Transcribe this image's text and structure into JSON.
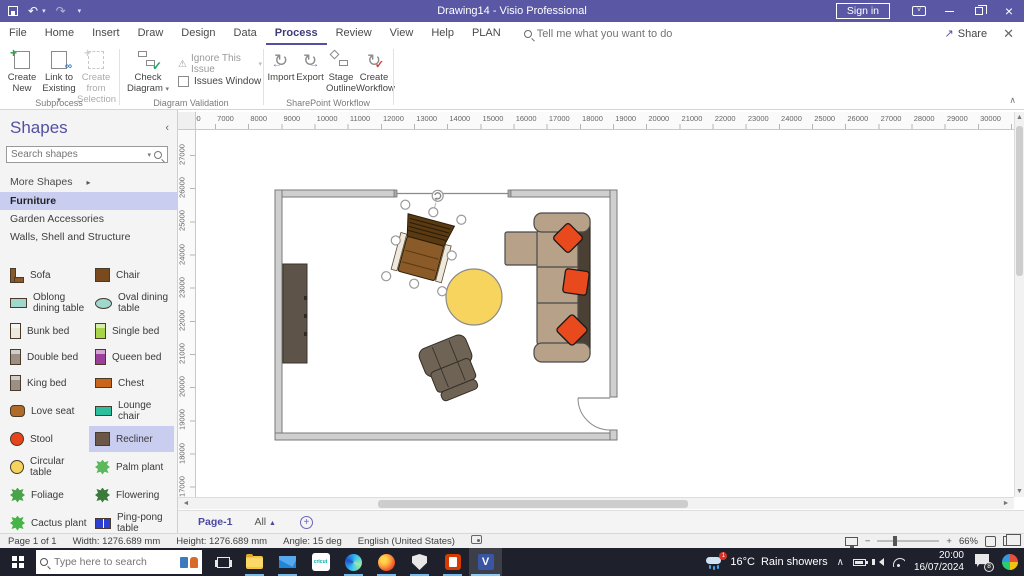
{
  "titlebar": {
    "title": "Drawing14 - Visio Professional",
    "sign_in": "Sign in"
  },
  "menu": {
    "tabs": [
      "File",
      "Home",
      "Insert",
      "Draw",
      "Design",
      "Data",
      "Process",
      "Review",
      "View",
      "Help",
      "PLAN"
    ],
    "active_tab": "Process",
    "search_placeholder": "Tell me what you want to do",
    "share": "Share"
  },
  "ribbon": {
    "subprocess": {
      "label": "Subprocess",
      "create_new": "Create New",
      "link_to_existing": "Link to Existing",
      "create_from_selection": "Create from Selection"
    },
    "validation": {
      "label": "Diagram Validation",
      "check_diagram": "Check Diagram",
      "ignore_issue": "Ignore This Issue",
      "issues_window": "Issues Window"
    },
    "sharepoint": {
      "label": "SharePoint Workflow",
      "import": "Import",
      "export": "Export",
      "stage_outline": "Stage Outline",
      "create_workflow": "Create Workflow"
    }
  },
  "shapes_panel": {
    "title": "Shapes",
    "search_placeholder": "Search shapes",
    "more_shapes": "More Shapes",
    "stencils": [
      "Furniture",
      "Garden Accessories",
      "Walls, Shell and Structure"
    ],
    "active_stencil": "Furniture",
    "items": [
      {
        "label": "Sofa",
        "icon": "sofa-icon",
        "shape": "sofa",
        "color": "#8a5a2b",
        "selected": false
      },
      {
        "label": "Chair",
        "icon": "chair-icon",
        "shape": "square",
        "color": "#7a4a1f",
        "selected": false
      },
      {
        "label": "Oblong dining table",
        "icon": "oblong-dining-table-icon",
        "shape": "rect",
        "color": "#9fd8cf",
        "selected": false
      },
      {
        "label": "Oval dining table",
        "icon": "oval-dining-table-icon",
        "shape": "ellipse",
        "color": "#9fd8cf",
        "selected": false
      },
      {
        "label": "Bunk bed",
        "icon": "bunk-bed-icon",
        "shape": "bed",
        "color": "#eceadf",
        "selected": false
      },
      {
        "label": "Single bed",
        "icon": "single-bed-icon",
        "shape": "bed",
        "color": "#a8d44a",
        "selected": false
      },
      {
        "label": "Double bed",
        "icon": "double-bed-icon",
        "shape": "bed",
        "color": "#9a9088",
        "selected": false
      },
      {
        "label": "Queen bed",
        "icon": "queen-bed-icon",
        "shape": "bed",
        "color": "#9b3f9b",
        "selected": false
      },
      {
        "label": "King bed",
        "icon": "king-bed-icon",
        "shape": "bed",
        "color": "#9a9088",
        "selected": false
      },
      {
        "label": "Chest",
        "icon": "chest-icon",
        "shape": "rect",
        "color": "#c8651b",
        "selected": false
      },
      {
        "label": "Love seat",
        "icon": "love-seat-icon",
        "shape": "roundrect",
        "color": "#b06a2a",
        "selected": false
      },
      {
        "label": "Lounge chair",
        "icon": "lounge-chair-icon",
        "shape": "rect",
        "color": "#2bbfa0",
        "selected": false
      },
      {
        "label": "Stool",
        "icon": "stool-icon",
        "shape": "circle",
        "color": "#e8441c",
        "selected": false
      },
      {
        "label": "Recliner",
        "icon": "recliner-icon",
        "shape": "square",
        "color": "#6b5747",
        "selected": true
      },
      {
        "label": "Circular table",
        "icon": "circular-table-icon",
        "shape": "circle",
        "color": "#f6d35c",
        "selected": false
      },
      {
        "label": "Palm plant",
        "icon": "palm-plant-icon",
        "shape": "plant",
        "color": "#5cb85c",
        "selected": false
      },
      {
        "label": "Foliage",
        "icon": "foliage-icon",
        "shape": "plant",
        "color": "#4aa34a",
        "selected": false
      },
      {
        "label": "Flowering",
        "icon": "flowering-icon",
        "shape": "plant",
        "color": "#3a7a3a",
        "selected": false
      },
      {
        "label": "Cactus plant",
        "icon": "cactus-plant-icon",
        "shape": "plant",
        "color": "#46b446",
        "selected": false
      },
      {
        "label": "Ping-pong table",
        "icon": "ping-pong-table-icon",
        "shape": "pingpong",
        "color": "#2a3fd4",
        "selected": false
      }
    ]
  },
  "rulers": {
    "top_labels": [
      "6000",
      "7000",
      "8000",
      "9000",
      "10000",
      "11000",
      "12000",
      "13000",
      "14000",
      "15000",
      "16000",
      "17000",
      "18000",
      "19000",
      "20000",
      "21000",
      "22000",
      "23000",
      "24000",
      "25000",
      "26000",
      "27000",
      "28000",
      "29000",
      "30000"
    ],
    "left_labels": [
      "27000",
      "26000",
      "25000",
      "24000",
      "23000",
      "22000",
      "21000",
      "20000",
      "19000",
      "18000",
      "17000"
    ]
  },
  "page_tabs": {
    "active": "Page-1",
    "all": "All"
  },
  "status_bar": {
    "page_info": "Page 1 of 1",
    "width": "Width: 1276.689 mm",
    "height": "Height: 1276.689 mm",
    "angle": "Angle: 15 deg",
    "language": "English (United States)",
    "zoom_level": "66%"
  },
  "taskbar": {
    "search_placeholder": "Type here to search",
    "cricut_label": "cricut",
    "visio_letter": "V",
    "weather": {
      "temp": "16°C",
      "condition": "Rain showers",
      "badge": "1"
    },
    "clock": {
      "time": "20:00",
      "date": "16/07/2024"
    },
    "notification_count": "8"
  },
  "canvas": {
    "selected_shape_angle_deg": 15,
    "colors": {
      "page": "#ffffff",
      "wall_fill": "#cfcfcf",
      "wall_stroke": "#787878",
      "sofa": "#b7a189",
      "sofa_back": "#4b4034",
      "pillow": "#e8491d",
      "table": "#f7d45e",
      "chair": "#8a5a28",
      "chair_dark": "#5a3a12",
      "recliner": "#6e6354",
      "console": "#5d5349"
    }
  },
  "icons": {
    "dropdown": "▾",
    "panel_collapse": "‹",
    "more_arrow": "▸",
    "all_caret": "▲",
    "add_page": "+",
    "collapse_ribbon": "∧",
    "undo": "↶",
    "redo": "↷",
    "share_arrow": "↗",
    "warning": "⚠",
    "refresh": "↻",
    "arrow_left": "←",
    "arrow_right": "→",
    "check": "✓",
    "up_arrow": "▲",
    "down_arrow": "▼",
    "left_arrow_s": "◄",
    "right_arrow_s": "►",
    "tray_chevron": "∧"
  }
}
